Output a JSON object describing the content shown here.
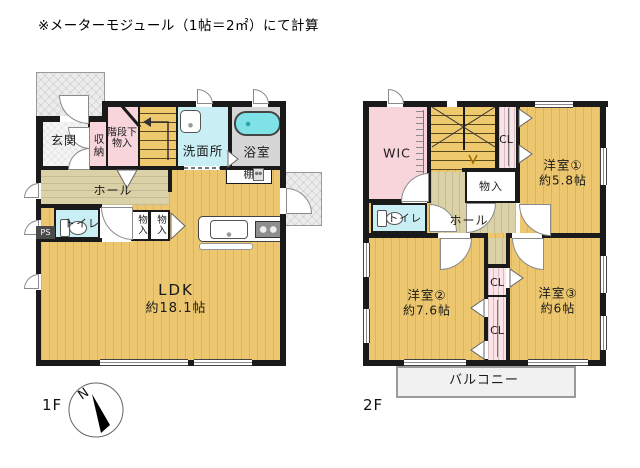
{
  "note": "※メーターモジュール（1帖＝2㎡）にて計算",
  "f1": {
    "label": "1F",
    "genkan": "玄関",
    "shuno": "収納",
    "kaidan1": "階段下",
    "kaidan2": "物入",
    "senmen": "洗面所",
    "bath": "浴室",
    "tana": "棚",
    "hall": "ホール",
    "toilet": "トイレ",
    "mono1": "物入",
    "mono2": "物入",
    "ldk": "LDK",
    "ldk_size": "約18.1帖",
    "ps": "PS",
    "compass_n": "N"
  },
  "f2": {
    "label": "2F",
    "wic": "WIC",
    "cl_top": "CL",
    "room1": "洋室①",
    "room1_size": "約5.8帖",
    "mono": "物入",
    "toilet": "トイレ",
    "hall": "ホール",
    "room2": "洋室②",
    "room2_size": "約7.6帖",
    "room3": "洋室③",
    "room3_size": "約6帖",
    "cl_mid": "CL",
    "cl_bottom": "CL",
    "balcony": "バルコニー"
  },
  "colors": {
    "wall": "#1a1a1a",
    "room_yellow": "#edc76f",
    "hall_beige": "#dbd1a6",
    "closet_pink": "#f8d4db",
    "water_cyan": "#c9eff4",
    "bath_gray": "#d6d6d6",
    "tub_cyan": "#7fe2e6",
    "outdoor_gray": "#ececec"
  },
  "icons": {
    "compass": "compass-rose",
    "sink": "kitchen-sink",
    "stove": "stove",
    "tub": "bathtub",
    "toilet": "toilet",
    "washbasin": "washbasin"
  }
}
